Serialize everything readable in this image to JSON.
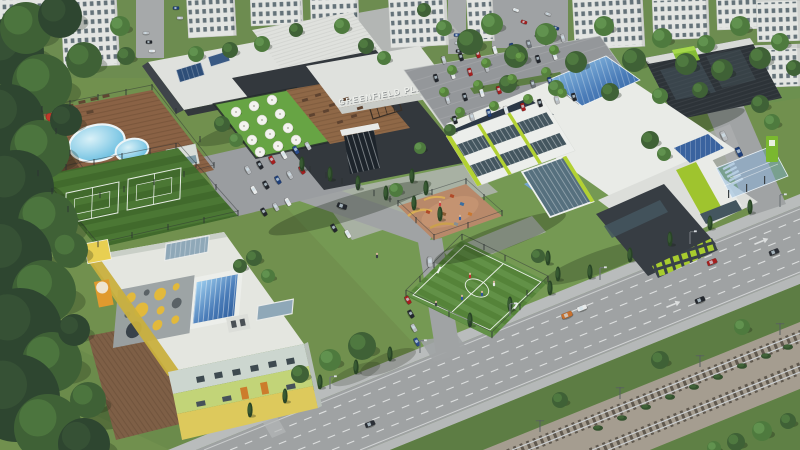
{
  "sign": {
    "text": "GREENFIELD PLAZA"
  },
  "palette": {
    "grass_base": "#71904e",
    "grass_top": "#6d8c50",
    "grass_light": "#7aa257",
    "grass_dark": "#5d7d44",
    "road": "#9fa2a3",
    "road_light": "#abaeaf",
    "sidewalk": "#b9bcbc",
    "asphalt_lot": "#94979a",
    "ballast": "#a59d90",
    "rail": "#ccd0d3",
    "roof_white": "#dfe1dd",
    "school_white": "#e9ebe7",
    "charcoal": "#33383d",
    "garage_dark": "#2d3338",
    "lime": "#b2d133",
    "lime_mid": "#9fc42e",
    "green_roof": "#67a444",
    "garage_green": "#85bd36",
    "water_light": "#d9f1f8",
    "water_deep": "#56b5dc",
    "deck_wood": "#8a6245",
    "sand": "#b8896a",
    "kg_yellow": "#e8cf52",
    "kg_green_band": "#c2d478",
    "kg_band_top": "#ccd6cf",
    "kg_band_bottom": "#ddc95c",
    "kg_orange": "#cc7c2c",
    "canopy_gray": "#9aa1a3",
    "apt_wall": "#e3e5e2",
    "apt_window": "#4e5e66",
    "umbrella_white": "#f3f3ef",
    "umbrella_red": "#c0392b",
    "forest_dark": "#2e4630",
    "car_colors": {
      "k": "#23272d",
      "s": "#b9bdc1",
      "r": "#a61e1e",
      "b": "#1f3f7a",
      "w": "#e8eaea",
      "g": "#6e747a",
      "o": "#c8712e",
      "n": "#2b2f36",
      "B": "#2a4a8a"
    },
    "tree_tones": [
      [
        "#2e4630",
        "#3a5638"
      ],
      [
        "#3f6136",
        "#527e42"
      ],
      [
        "#4e7a3e",
        "#659652"
      ],
      [
        "#55813c",
        "#6ba14c"
      ]
    ],
    "hole_colors": {
      "y": "#e2b93c",
      "d": "#5a6266",
      "dd": "#39424a"
    }
  },
  "apartments": [
    [
      60,
      -8,
      56,
      76,
      -3
    ],
    [
      186,
      -10,
      48,
      48,
      -3
    ],
    [
      250,
      -8,
      52,
      34,
      -2
    ],
    [
      310,
      -6,
      48,
      30,
      -2
    ],
    [
      388,
      -8,
      58,
      56,
      -3
    ],
    [
      466,
      -8,
      26,
      50,
      -3
    ],
    [
      572,
      -8,
      70,
      58,
      -3
    ],
    [
      652,
      -4,
      56,
      44,
      -2
    ],
    [
      716,
      -10,
      50,
      40,
      -2
    ],
    [
      756,
      -2,
      44,
      44,
      -2
    ],
    [
      742,
      46,
      58,
      42,
      -2
    ],
    [
      -6,
      -6,
      70,
      30,
      -2
    ]
  ],
  "forest": [
    [
      10,
      52,
      34,
      0
    ],
    [
      42,
      84,
      30,
      1
    ],
    [
      8,
      120,
      36,
      0
    ],
    [
      40,
      150,
      30,
      1
    ],
    [
      16,
      188,
      38,
      0
    ],
    [
      48,
      222,
      30,
      1
    ],
    [
      12,
      258,
      40,
      0
    ],
    [
      44,
      292,
      32,
      1
    ],
    [
      20,
      330,
      42,
      0
    ],
    [
      52,
      362,
      30,
      1
    ],
    [
      16,
      398,
      44,
      0
    ],
    [
      48,
      428,
      34,
      1
    ],
    [
      84,
      444,
      26,
      0
    ],
    [
      26,
      28,
      26,
      1
    ],
    [
      60,
      16,
      22,
      0
    ],
    [
      84,
      60,
      18,
      1
    ],
    [
      66,
      120,
      16,
      0
    ],
    [
      70,
      250,
      18,
      1
    ],
    [
      74,
      330,
      16,
      0
    ],
    [
      88,
      400,
      18,
      1
    ]
  ],
  "trees": [
    [
      120,
      26,
      10,
      2
    ],
    [
      126,
      56,
      9,
      1
    ],
    [
      196,
      54,
      8,
      2
    ],
    [
      230,
      50,
      8,
      1
    ],
    [
      262,
      44,
      8,
      2
    ],
    [
      296,
      30,
      7,
      1
    ],
    [
      342,
      26,
      8,
      2
    ],
    [
      366,
      46,
      8,
      1
    ],
    [
      384,
      58,
      7,
      2
    ],
    [
      470,
      42,
      13,
      1
    ],
    [
      492,
      24,
      11,
      2
    ],
    [
      516,
      56,
      12,
      1
    ],
    [
      546,
      34,
      11,
      2
    ],
    [
      576,
      62,
      11,
      1
    ],
    [
      604,
      26,
      10,
      2
    ],
    [
      634,
      60,
      12,
      1
    ],
    [
      662,
      38,
      10,
      2
    ],
    [
      686,
      64,
      11,
      1
    ],
    [
      706,
      44,
      9,
      2
    ],
    [
      722,
      70,
      11,
      1
    ],
    [
      740,
      26,
      10,
      2
    ],
    [
      760,
      58,
      11,
      1
    ],
    [
      780,
      42,
      9,
      2
    ],
    [
      794,
      68,
      8,
      1
    ],
    [
      424,
      10,
      7,
      1
    ],
    [
      444,
      28,
      8,
      2
    ],
    [
      508,
      84,
      9,
      1
    ],
    [
      556,
      88,
      8,
      2
    ],
    [
      610,
      92,
      9,
      1
    ],
    [
      660,
      96,
      8,
      2
    ],
    [
      700,
      90,
      8,
      1
    ],
    [
      650,
      140,
      9,
      1
    ],
    [
      664,
      154,
      7,
      2
    ],
    [
      760,
      104,
      9,
      1
    ],
    [
      772,
      122,
      8,
      2
    ],
    [
      362,
      346,
      14,
      1
    ],
    [
      330,
      360,
      11,
      2
    ],
    [
      300,
      374,
      9,
      1
    ],
    [
      396,
      190,
      7,
      2
    ],
    [
      254,
      258,
      8,
      1
    ],
    [
      268,
      276,
      7,
      2
    ],
    [
      240,
      266,
      7,
      1
    ],
    [
      538,
      256,
      7,
      1
    ],
    [
      420,
      148,
      6,
      2
    ],
    [
      450,
      130,
      6,
      1
    ],
    [
      222,
      124,
      8,
      1
    ],
    [
      236,
      140,
      7,
      2
    ],
    [
      560,
      400,
      8,
      1
    ],
    [
      660,
      360,
      9,
      1
    ],
    [
      742,
      327,
      8,
      2
    ],
    [
      736,
      442,
      9,
      1
    ],
    [
      762,
      431,
      10,
      2
    ],
    [
      788,
      421,
      8,
      1
    ],
    [
      714,
      448,
      7,
      2
    ],
    [
      452,
      70,
      5,
      3
    ],
    [
      486,
      63,
      5,
      3
    ],
    [
      520,
      57,
      5,
      3
    ],
    [
      554,
      50,
      5,
      3
    ],
    [
      444,
      92,
      5,
      3
    ],
    [
      478,
      85,
      5,
      3
    ],
    [
      512,
      79,
      5,
      3
    ],
    [
      546,
      72,
      5,
      3
    ],
    [
      460,
      112,
      5,
      3
    ],
    [
      494,
      106,
      5,
      3
    ],
    [
      528,
      99,
      5,
      3
    ],
    [
      562,
      93,
      5,
      3
    ]
  ],
  "cypresses": [
    [
      302,
      164
    ],
    [
      330,
      174
    ],
    [
      358,
      183
    ],
    [
      386,
      193
    ],
    [
      414,
      203
    ],
    [
      412,
      176
    ],
    [
      426,
      188
    ],
    [
      440,
      214
    ],
    [
      250,
      410
    ],
    [
      285,
      396
    ],
    [
      320,
      382
    ],
    [
      356,
      367
    ],
    [
      390,
      354
    ],
    [
      470,
      320
    ],
    [
      510,
      304
    ],
    [
      550,
      288
    ],
    [
      590,
      272
    ],
    [
      630,
      255
    ],
    [
      670,
      239
    ],
    [
      710,
      223
    ],
    [
      750,
      207
    ],
    [
      548,
      258
    ],
    [
      558,
      274
    ]
  ],
  "bushes": [
    [
      598,
      428
    ],
    [
      622,
      418
    ],
    [
      646,
      407
    ],
    [
      670,
      397
    ],
    [
      694,
      387
    ],
    [
      718,
      377
    ],
    [
      742,
      366
    ],
    [
      766,
      356
    ],
    [
      788,
      347
    ]
  ],
  "umbrellas": [
    [
      236,
      112
    ],
    [
      254,
      106
    ],
    [
      272,
      100
    ],
    [
      244,
      126
    ],
    [
      262,
      120
    ],
    [
      280,
      114
    ],
    [
      252,
      140
    ],
    [
      270,
      134
    ],
    [
      288,
      128
    ],
    [
      260,
      152
    ],
    [
      278,
      146
    ],
    [
      296,
      140
    ]
  ],
  "plaza_deck_furniture": [
    [
      305,
      100
    ],
    [
      318,
      95
    ],
    [
      332,
      105
    ],
    [
      346,
      99
    ],
    [
      312,
      115
    ],
    [
      326,
      111
    ],
    [
      340,
      122
    ],
    [
      354,
      116
    ],
    [
      360,
      108
    ]
  ],
  "pool_furniture": [
    [
      58,
      110
    ],
    [
      70,
      106
    ],
    [
      82,
      102
    ],
    [
      94,
      99
    ],
    [
      106,
      96
    ],
    [
      66,
      120
    ],
    [
      78,
      116
    ],
    [
      90,
      112
    ]
  ],
  "pool_loungers": [
    [
      46,
      125
    ],
    [
      43,
      139
    ],
    [
      40,
      152
    ]
  ],
  "pool_umbrellas": [
    [
      50,
      117,
      4
    ],
    [
      44,
      141,
      4
    ],
    [
      53,
      158,
      3.5
    ]
  ],
  "cars": [
    [
      146,
      33,
      0,
      "s",
      0.62
    ],
    [
      149,
      42,
      0,
      "k",
      0.62
    ],
    [
      152,
      51,
      0,
      "w",
      0.62
    ],
    [
      457,
      35,
      0,
      "B",
      0.62
    ],
    [
      458,
      43,
      0,
      "s",
      0.62
    ],
    [
      459,
      51,
      0,
      "k",
      0.62
    ],
    [
      516,
      10,
      20,
      "w",
      0.62
    ],
    [
      524,
      22,
      20,
      "r",
      0.62
    ],
    [
      548,
      14,
      20,
      "s",
      0.62
    ],
    [
      556,
      28,
      20,
      "b",
      0.62
    ],
    [
      538,
      36,
      20,
      "k",
      0.62
    ],
    [
      176,
      8,
      0,
      "b",
      0.62
    ],
    [
      180,
      18,
      0,
      "s",
      0.62
    ],
    [
      444,
      60,
      73,
      "s",
      0.8
    ],
    [
      461,
      57,
      73,
      "k",
      0.8
    ],
    [
      478,
      54,
      73,
      "r",
      0.8
    ],
    [
      495,
      50,
      73,
      "w",
      0.8
    ],
    [
      512,
      47,
      73,
      "b",
      0.8
    ],
    [
      529,
      44,
      73,
      "g",
      0.8
    ],
    [
      546,
      41,
      73,
      "k",
      0.8
    ],
    [
      563,
      38,
      73,
      "s",
      0.8
    ],
    [
      436,
      78,
      73,
      "k",
      0.8
    ],
    [
      453,
      75,
      73,
      "w",
      0.8
    ],
    [
      470,
      72,
      73,
      "r",
      0.8
    ],
    [
      487,
      68,
      73,
      "s",
      0.8
    ],
    [
      521,
      62,
      73,
      "b",
      0.8
    ],
    [
      538,
      59,
      73,
      "k",
      0.8
    ],
    [
      555,
      56,
      73,
      "w",
      0.8
    ],
    [
      448,
      100,
      73,
      "s",
      0.8
    ],
    [
      465,
      97,
      73,
      "k",
      0.8
    ],
    [
      482,
      93,
      73,
      "w",
      0.8
    ],
    [
      499,
      90,
      73,
      "r",
      0.8
    ],
    [
      533,
      84,
      73,
      "g",
      0.8
    ],
    [
      550,
      81,
      73,
      "b",
      0.8
    ],
    [
      455,
      120,
      73,
      "k",
      0.8
    ],
    [
      472,
      117,
      73,
      "s",
      0.8
    ],
    [
      489,
      113,
      73,
      "b",
      0.8
    ],
    [
      506,
      110,
      73,
      "w",
      0.8
    ],
    [
      523,
      107,
      73,
      "r",
      0.8
    ],
    [
      540,
      103,
      73,
      "k",
      0.8
    ],
    [
      557,
      100,
      73,
      "s",
      0.8
    ],
    [
      574,
      97,
      73,
      "k",
      0.8
    ],
    [
      248,
      170,
      60,
      "s",
      0.85
    ],
    [
      260,
      165,
      60,
      "k",
      0.85
    ],
    [
      272,
      160,
      60,
      "r",
      0.85
    ],
    [
      284,
      155,
      60,
      "w",
      0.85
    ],
    [
      296,
      150,
      60,
      "B",
      0.85
    ],
    [
      308,
      146,
      60,
      "s",
      0.85
    ],
    [
      254,
      190,
      60,
      "w",
      0.85
    ],
    [
      266,
      185,
      60,
      "k",
      0.85
    ],
    [
      278,
      180,
      60,
      "b",
      0.85
    ],
    [
      290,
      175,
      60,
      "s",
      0.85
    ],
    [
      302,
      170,
      60,
      "r",
      0.85
    ],
    [
      264,
      212,
      60,
      "k",
      0.85
    ],
    [
      276,
      207,
      60,
      "s",
      0.85
    ],
    [
      288,
      202,
      60,
      "w",
      0.85
    ],
    [
      408,
      300,
      60,
      "r",
      0.85
    ],
    [
      411,
      314,
      60,
      "k",
      0.85
    ],
    [
      414,
      328,
      60,
      "s",
      0.85
    ],
    [
      417,
      342,
      60,
      "B",
      0.85
    ],
    [
      334,
      228,
      60,
      "k",
      0.85
    ],
    [
      348,
      234,
      60,
      "w",
      0.85
    ],
    [
      342,
      206,
      19,
      "k",
      1
    ],
    [
      430,
      262,
      86,
      "s",
      1
    ],
    [
      370,
      424,
      -22,
      "n",
      1
    ],
    [
      567,
      315,
      -22,
      "o",
      1.1
    ],
    [
      582,
      308,
      -22,
      "w",
      1
    ],
    [
      700,
      300,
      -22,
      "k",
      1
    ],
    [
      712,
      262,
      -22,
      "r",
      1
    ],
    [
      774,
      252,
      -22,
      "n",
      1
    ],
    [
      724,
      136,
      64,
      "s",
      1
    ],
    [
      739,
      152,
      64,
      "b",
      1
    ]
  ],
  "posts": [
    [
      38,
      176
    ],
    [
      66,
      170
    ],
    [
      94,
      165
    ],
    [
      122,
      159
    ],
    [
      150,
      154
    ],
    [
      176,
      149
    ],
    [
      196,
      168
    ],
    [
      216,
      190
    ],
    [
      238,
      216
    ],
    [
      204,
      223
    ],
    [
      168,
      230
    ],
    [
      132,
      238
    ],
    [
      98,
      247
    ],
    [
      68,
      212
    ],
    [
      52,
      194
    ],
    [
      42,
      112
    ],
    [
      70,
      106
    ],
    [
      98,
      100
    ],
    [
      126,
      95
    ],
    [
      152,
      90
    ],
    [
      176,
      114
    ],
    [
      200,
      142
    ],
    [
      214,
      168
    ],
    [
      184,
      177
    ],
    [
      154,
      185
    ],
    [
      124,
      192
    ],
    [
      100,
      198
    ],
    [
      70,
      156
    ],
    [
      56,
      134
    ],
    [
      462,
      240
    ],
    [
      505,
      261
    ],
    [
      548,
      282
    ],
    [
      520,
      310
    ],
    [
      492,
      338
    ],
    [
      449,
      317
    ],
    [
      406,
      296
    ],
    [
      434,
      268
    ],
    [
      484,
      250
    ],
    [
      527,
      296
    ],
    [
      470,
      327
    ],
    [
      420,
      282
    ],
    [
      398,
      206
    ],
    [
      432,
      195
    ],
    [
      466,
      184
    ],
    [
      484,
      200
    ],
    [
      502,
      216
    ],
    [
      468,
      228
    ],
    [
      434,
      240
    ],
    [
      416,
      223
    ],
    [
      310,
      172
    ],
    [
      326,
      178
    ],
    [
      342,
      184
    ],
    [
      358,
      190
    ],
    [
      374,
      196
    ],
    [
      390,
      202
    ]
  ],
  "lights": [
    [
      330,
      389
    ],
    [
      420,
      353
    ],
    [
      510,
      316
    ],
    [
      600,
      280
    ],
    [
      690,
      244
    ],
    [
      780,
      207
    ]
  ],
  "masts": [
    [
      540,
      432
    ],
    [
      620,
      399
    ],
    [
      700,
      367
    ],
    [
      780,
      335
    ]
  ],
  "people": [
    [
      377,
      258,
      "#3a3f46"
    ],
    [
      436,
      306,
      "#3a3f46"
    ],
    [
      470,
      278,
      "#c23030"
    ],
    [
      482,
      296,
      "#3055a0"
    ],
    [
      494,
      286,
      "#e8e8e8"
    ],
    [
      462,
      300,
      "#3055a0"
    ],
    [
      440,
      206,
      "#d04040"
    ],
    [
      460,
      220,
      "#3060a8"
    ]
  ],
  "kindergarten": {
    "windows": [
      [
        196,
        377
      ],
      [
        214,
        373
      ],
      [
        232,
        370
      ],
      [
        250,
        366
      ],
      [
        268,
        362
      ],
      [
        286,
        359
      ]
    ],
    "low_windows": [
      [
        196,
        402
      ],
      [
        222,
        397
      ],
      [
        286,
        385
      ]
    ],
    "doors": [
      [
        240,
        388
      ],
      [
        260,
        383
      ]
    ],
    "canopy_holes": [
      [
        14,
        10,
        5,
        "y"
      ],
      [
        30,
        8,
        3,
        "d"
      ],
      [
        44,
        12,
        6,
        "y"
      ],
      [
        60,
        8,
        3.5,
        "y"
      ],
      [
        12,
        26,
        3,
        "d"
      ],
      [
        26,
        24,
        7,
        "y"
      ],
      [
        46,
        28,
        4,
        "y"
      ],
      [
        62,
        24,
        5,
        "d"
      ],
      [
        20,
        42,
        8,
        "dd"
      ],
      [
        44,
        42,
        5,
        "y"
      ],
      [
        62,
        40,
        4,
        "y"
      ]
    ]
  },
  "playground_items": [
    [
      452,
      196,
      "#b04a28"
    ],
    [
      462,
      204,
      "#3a6ea0"
    ],
    [
      444,
      214,
      "#8a5a32"
    ],
    [
      470,
      214,
      "#c87830"
    ],
    [
      456,
      224,
      "#888f93"
    ],
    [
      428,
      212,
      "#b04a28"
    ]
  ]
}
